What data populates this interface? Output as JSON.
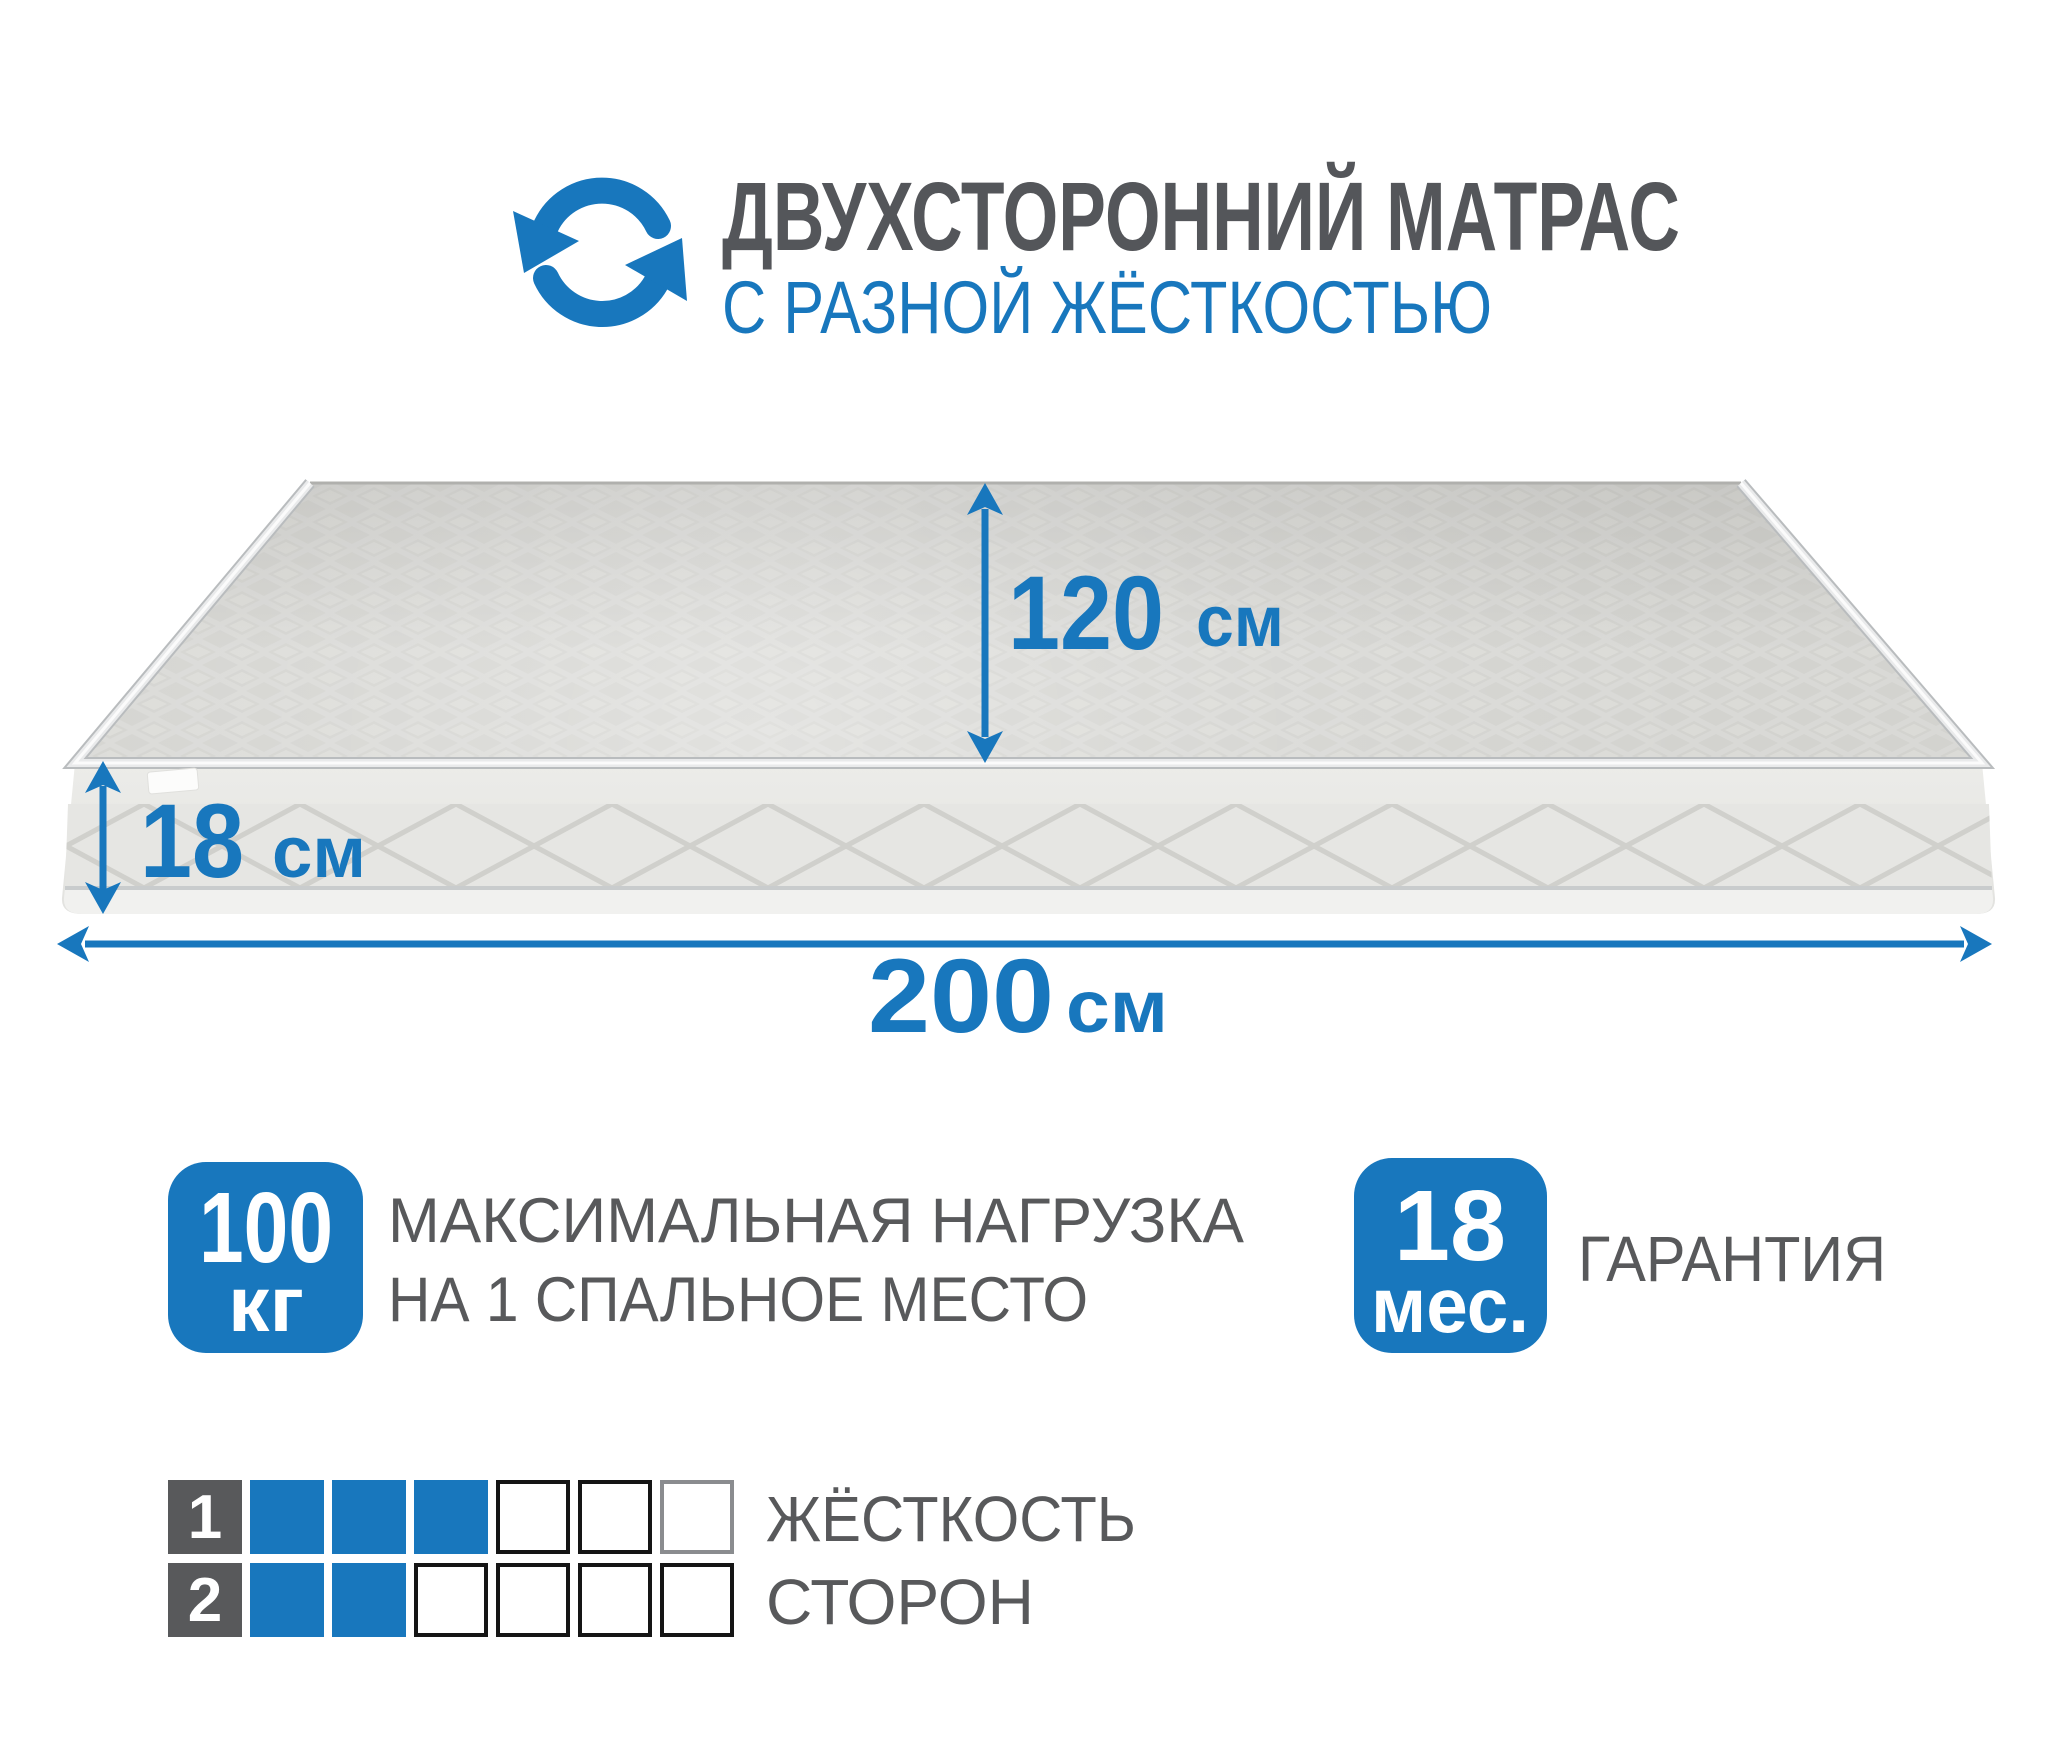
{
  "header": {
    "icon": "rotate-arrows-icon",
    "title": "ДВУХСТОРОННИЙ МАТРАС",
    "subtitle": "С РАЗНОЙ ЖЁСТКОСТЬЮ"
  },
  "mattress": {
    "dimensions": {
      "depth": {
        "value": "120",
        "unit": "см"
      },
      "height": {
        "value": "18",
        "unit": "см"
      },
      "width": {
        "value": "200",
        "unit": "см"
      }
    }
  },
  "features": {
    "max_load": {
      "value": "100",
      "unit": "кг",
      "label_line1": "МАКСИМАЛЬНАЯ НАГРУЗКА",
      "label_line2": "НА 1 СПАЛЬНОЕ МЕСТО"
    },
    "warranty": {
      "value": "18",
      "unit": "мес.",
      "label": "ГАРАНТИЯ"
    }
  },
  "firmness_scale": {
    "label_line1": "ЖЁСТКОСТЬ",
    "label_line2": "СТОРОН",
    "total_cells": 6,
    "rows": [
      {
        "side": "1",
        "filled": 3,
        "muted_last": true
      },
      {
        "side": "2",
        "filled": 2,
        "muted_last": false
      }
    ]
  },
  "colors": {
    "accent_blue": "#1877BD",
    "title_gray": "#54565A",
    "text_gray": "#58595B",
    "dark_cell": "#58595B",
    "cell_border": "#151515",
    "cell_border_muted": "#8A8C8F"
  }
}
